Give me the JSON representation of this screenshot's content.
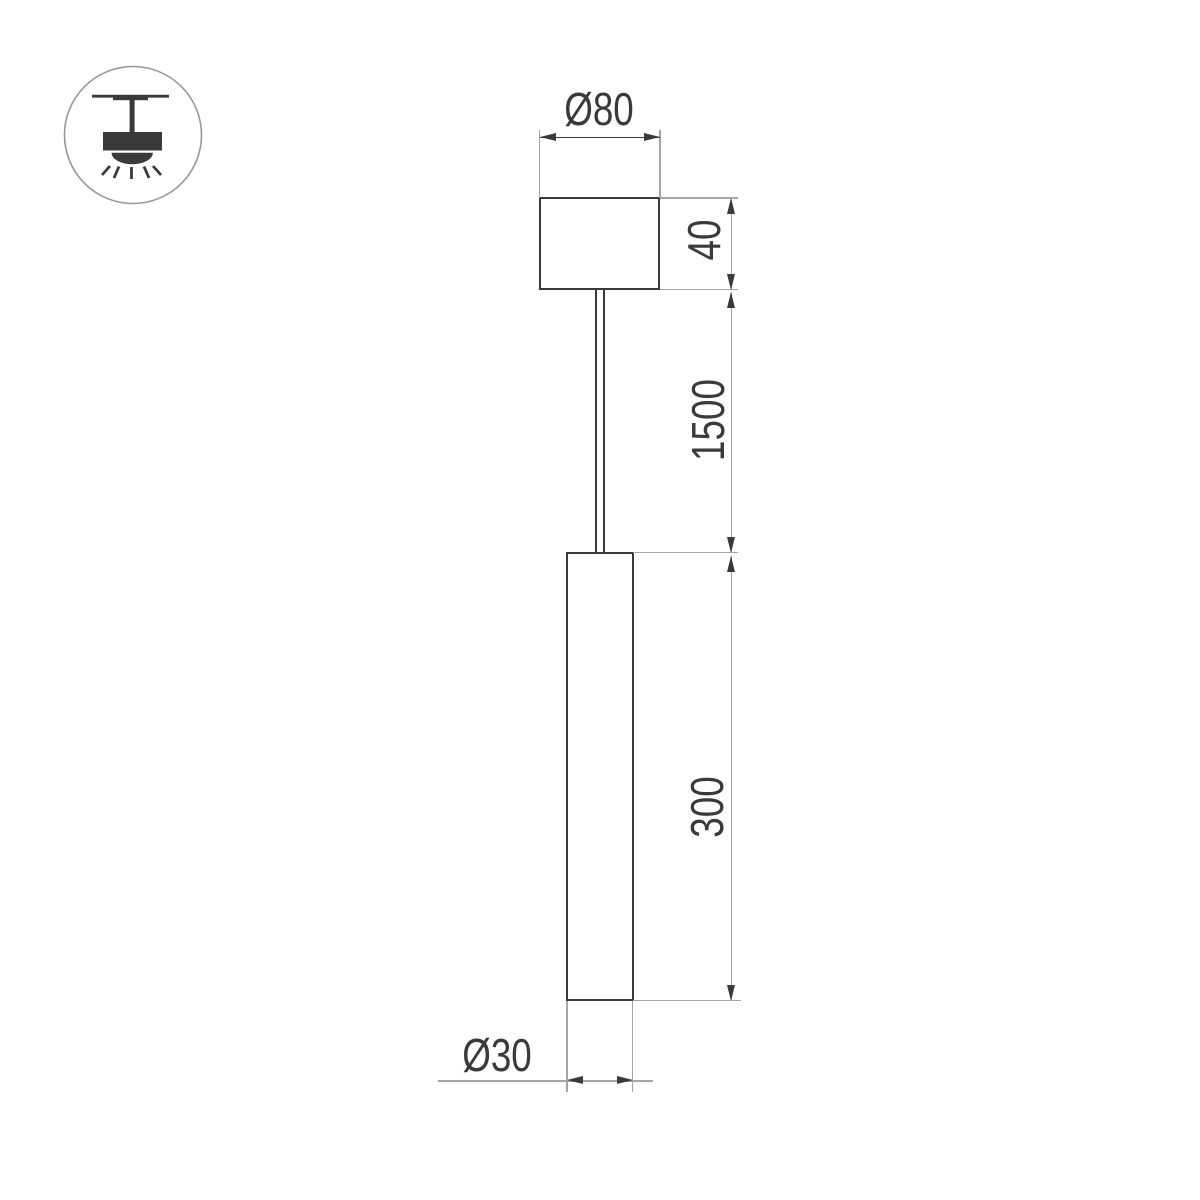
{
  "meta": {
    "kind": "technical-dimension-drawing",
    "subject": "ceiling pendant tube luminaire"
  },
  "colors": {
    "background": "#ffffff",
    "line_dark": "#3a3a3c",
    "line_light": "#a6a6a8",
    "icon_circle_border": "#98989a"
  },
  "icon": {
    "name": "ceiling-pendant-light-icon"
  },
  "dimensions": {
    "canopy_diameter": {
      "label": "Ø80",
      "value_mm": 80
    },
    "canopy_height": {
      "label": "40",
      "value_mm": 40
    },
    "suspension_length": {
      "label": "1500",
      "value_mm": 1500
    },
    "tube_length": {
      "label": "300",
      "value_mm": 300
    },
    "tube_diameter": {
      "label": "Ø30",
      "value_mm": 30
    }
  }
}
